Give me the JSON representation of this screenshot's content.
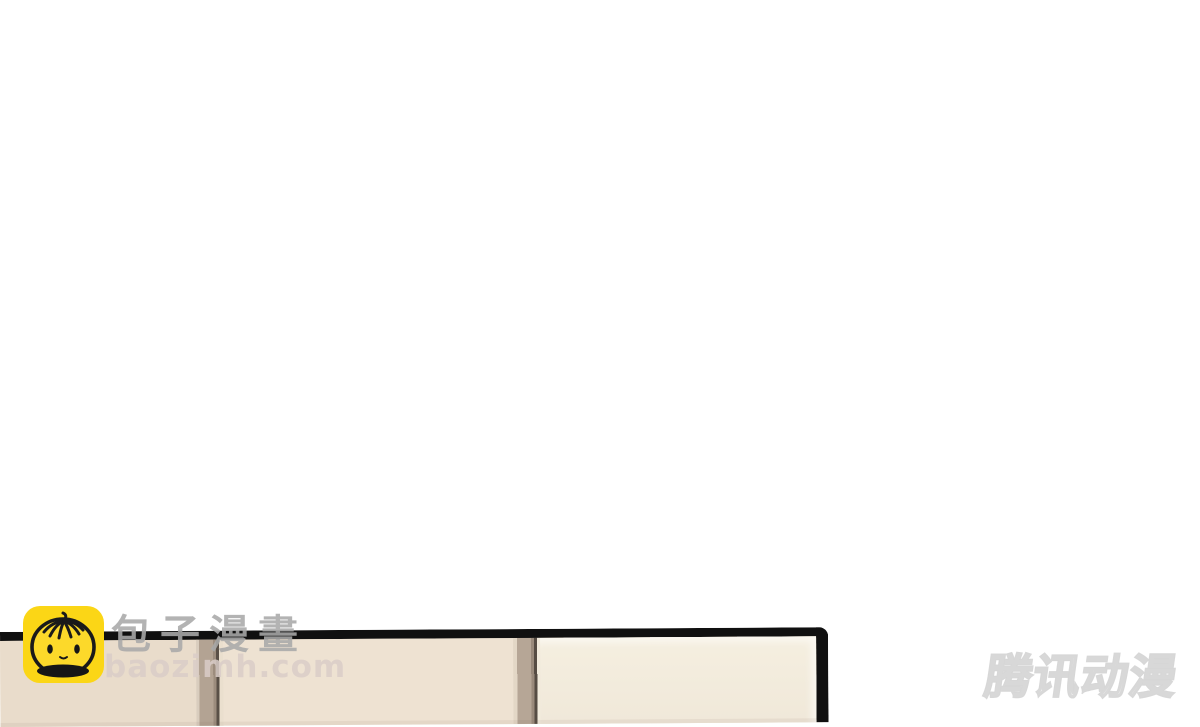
{
  "canvas": {
    "width": 1200,
    "height": 711,
    "background": "#ffffff"
  },
  "site_watermark": {
    "logo_icon": "baozi-bun-icon",
    "logo_bg_color": "#fbd616",
    "site_name": "包子漫畫",
    "site_domain": "baozimh.com",
    "site_name_color": "#a8a8a8",
    "site_domain_color": "#d9ccc8"
  },
  "publisher_watermark": {
    "text": "腾讯动漫",
    "outline_color": "#d6d6d6",
    "fill_color": "#ffffff"
  },
  "comic_panel": {
    "border_color": "#101010",
    "left_section_color": "#e9dccb",
    "middle_section_color": "#eee2d2",
    "right_section_color": "#f1e9da",
    "divider_color": "#b3a393",
    "divider_edge_color": "#5a5047"
  }
}
